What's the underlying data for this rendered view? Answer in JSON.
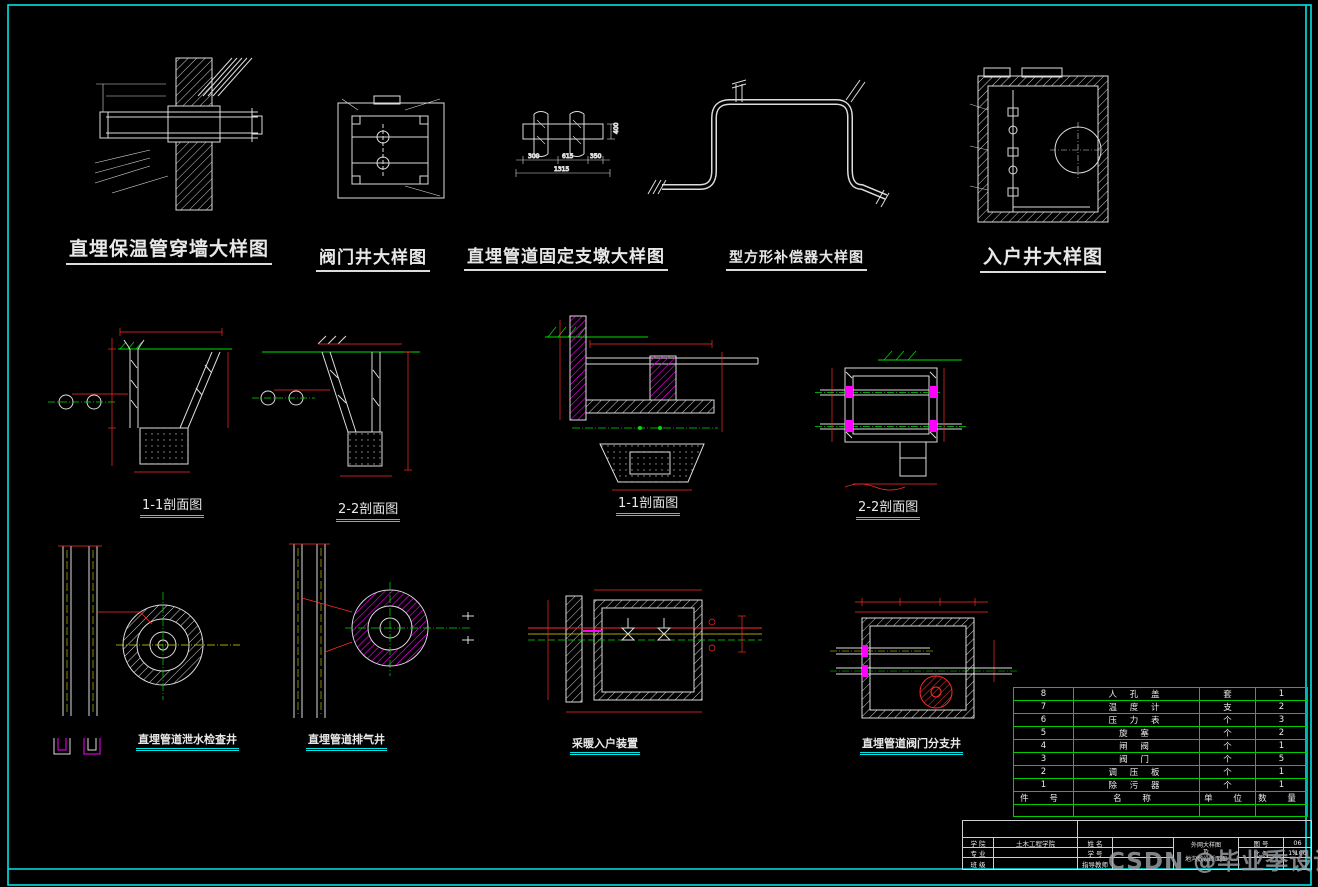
{
  "canvas": {
    "width": 1318,
    "height": 887,
    "background": "#000000"
  },
  "colors": {
    "frame": "#00e5e5",
    "line": "#e0e0e0",
    "dimension": "#ff2a2a",
    "centerline_green": "#00dd00",
    "centerline_yellow": "#dddd00",
    "hatch_magenta": "#ff00ff",
    "table_grid": "#00cc00",
    "watermark": "#9aa0a6"
  },
  "top_details": {
    "wall_penetration": {
      "title": "直埋保温管穿墙大样图"
    },
    "valve_well": {
      "title": "阀门井大样图"
    },
    "fixed_pier": {
      "title": "直埋管道固定支墩大样图",
      "dims": {
        "a": "300",
        "b": "615",
        "c": "350",
        "total": "1315",
        "height": "400"
      }
    },
    "compensator": {
      "title": "型方形补偿器大样图"
    },
    "entry_well": {
      "title": "入户井大样图"
    }
  },
  "sections": {
    "s1": {
      "label": "1-1剖面图"
    },
    "s2": {
      "label": "2-2剖面图"
    },
    "s3": {
      "label": "1-1剖面图"
    },
    "s4": {
      "label": "2-2剖面图"
    }
  },
  "plans": {
    "drain_well": {
      "label": "直埋管道泄水检查井"
    },
    "vent_well": {
      "label": "直埋管道排气井"
    },
    "entry_device": {
      "label": "采暖入户装置"
    },
    "branch_well": {
      "label": "直埋管道阀门分支井"
    }
  },
  "parts_table": {
    "headers": {
      "no": "件  号",
      "name": "名  称",
      "unit": "单 位",
      "qty": "数  量"
    },
    "rows": [
      {
        "no": "8",
        "name": "人 孔 盖",
        "unit": "套",
        "qty": "1"
      },
      {
        "no": "7",
        "name": "温 度 计",
        "unit": "支",
        "qty": "2"
      },
      {
        "no": "6",
        "name": "压 力 表",
        "unit": "个",
        "qty": "3"
      },
      {
        "no": "5",
        "name": "旋  塞",
        "unit": "个",
        "qty": "2"
      },
      {
        "no": "4",
        "name": "闸  阀",
        "unit": "个",
        "qty": "1"
      },
      {
        "no": "3",
        "name": "阀  门",
        "unit": "个",
        "qty": "5"
      },
      {
        "no": "2",
        "name": "调 压 板",
        "unit": "个",
        "qty": "1"
      },
      {
        "no": "1",
        "name": "除 污 器",
        "unit": "个",
        "qty": "1"
      }
    ]
  },
  "title_block": {
    "school_label": "学  院",
    "school_value": "土木工程学院",
    "major_label": "专  业",
    "major_value": "",
    "class_label": "班  级",
    "class_value": "",
    "name_label": "姓  名",
    "name_value": "",
    "id_label": "学  号",
    "id_value": "",
    "advisor_label": "指导教师",
    "advisor_value": "",
    "drawing_title_line1": "外网大样图",
    "drawing_title_line2": "及",
    "drawing_title_line3": "地沟敷设断面图",
    "figure_no_label": "图  号",
    "figure_no": "06",
    "scale_label": "比  例",
    "scale": "1:100"
  },
  "watermark": {
    "text": "CSDN @毕业季设计"
  }
}
